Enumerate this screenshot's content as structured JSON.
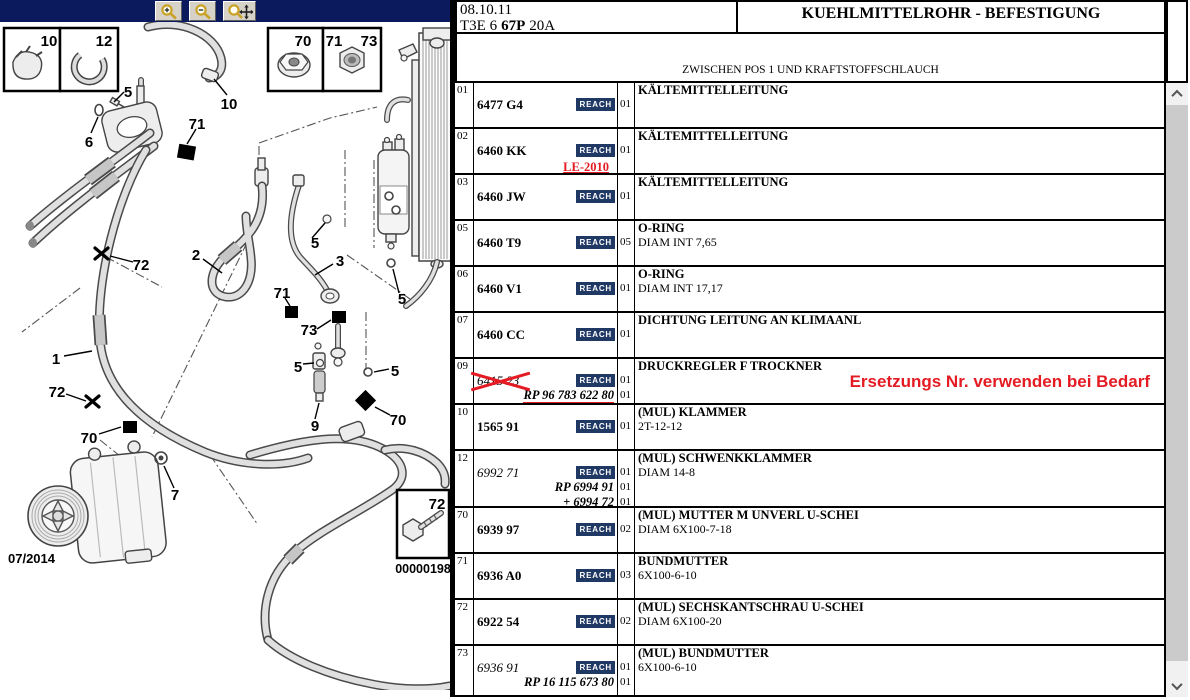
{
  "toolbar": {
    "bar_color": "#0a1a5c",
    "buttons": [
      {
        "icon": "zoom-in-icon"
      },
      {
        "icon": "zoom-out-icon"
      },
      {
        "icon": "zoom-pan-icon"
      }
    ]
  },
  "header": {
    "date": "08.10.11",
    "code": {
      "part1": "T3E 6",
      "part2": "67P",
      "part3": "20A"
    },
    "title": "KUEHLMITTELROHR - BEFESTIGUNG",
    "subtitle": "ZWISCHEN POS 1 UND KRAFTSTOFFSCHLAUCH"
  },
  "diagram": {
    "date_label": "07/2014",
    "image_number": "00000198",
    "callouts": [
      {
        "label": "10",
        "x": 49,
        "y": 41
      },
      {
        "label": "12",
        "x": 104,
        "y": 41
      },
      {
        "label": "70",
        "x": 303,
        "y": 41
      },
      {
        "label": "71",
        "x": 334,
        "y": 41
      },
      {
        "label": "73",
        "x": 369,
        "y": 41
      },
      {
        "label": "72",
        "x": 437,
        "y": 504
      },
      {
        "label": "5",
        "x": 128,
        "y": 92
      },
      {
        "label": "6",
        "x": 89,
        "y": 142
      },
      {
        "label": "10",
        "x": 229,
        "y": 104
      },
      {
        "label": "71",
        "x": 197,
        "y": 124
      },
      {
        "label": "2",
        "x": 196,
        "y": 255
      },
      {
        "label": "72",
        "x": 141,
        "y": 265
      },
      {
        "label": "3",
        "x": 340,
        "y": 261
      },
      {
        "label": "5",
        "x": 315,
        "y": 243
      },
      {
        "label": "5",
        "x": 402,
        "y": 299
      },
      {
        "label": "71",
        "x": 282,
        "y": 293
      },
      {
        "label": "73",
        "x": 309,
        "y": 330
      },
      {
        "label": "5",
        "x": 298,
        "y": 367
      },
      {
        "label": "5",
        "x": 395,
        "y": 371
      },
      {
        "label": "9",
        "x": 315,
        "y": 426
      },
      {
        "label": "70",
        "x": 398,
        "y": 420
      },
      {
        "label": "1",
        "x": 56,
        "y": 359
      },
      {
        "label": "72",
        "x": 57,
        "y": 392
      },
      {
        "label": "70",
        "x": 89,
        "y": 438
      },
      {
        "label": "7",
        "x": 175,
        "y": 495
      }
    ]
  },
  "table": {
    "reach_label": "REACH",
    "rows": [
      {
        "pos": "01",
        "part": "6477 G4",
        "style": "bold",
        "qty": [
          "01"
        ],
        "desc": [
          "KÄLTEMITTELLEITUNG"
        ]
      },
      {
        "pos": "02",
        "part": "6460 KK",
        "style": "bold",
        "qty": [
          "01"
        ],
        "desc": [
          "KÄLTEMITTELLEITUNG"
        ],
        "note": "LE-2010"
      },
      {
        "pos": "03",
        "part": "6460 JW",
        "style": "bold",
        "qty": [
          "01"
        ],
        "desc": [
          "KÄLTEMITTELLEITUNG"
        ]
      },
      {
        "pos": "05",
        "part": "6460 T9",
        "style": "bold",
        "qty": [
          "05"
        ],
        "desc": [
          "O-RING",
          "DIAM INT 7,65"
        ]
      },
      {
        "pos": "06",
        "part": "6460 V1",
        "style": "bold",
        "qty": [
          "01"
        ],
        "desc": [
          "O-RING",
          "DIAM INT 17,17"
        ]
      },
      {
        "pos": "07",
        "part": "6460 CC",
        "style": "bold",
        "qty": [
          "01"
        ],
        "desc": [
          "DICHTUNG LEITUNG AN KLIMAANL"
        ]
      },
      {
        "pos": "09",
        "part": "6415 23",
        "style": "italic",
        "crossed": true,
        "rp_lines": [
          {
            "text": "RP 96 783 622 80",
            "underline": true
          }
        ],
        "qty": [
          "01",
          "01"
        ],
        "desc": [
          "DRUCKREGLER F TROCKNER"
        ],
        "annotation": "Ersetzungs Nr. verwenden bei Bedarf"
      },
      {
        "pos": "10",
        "part": "1565 91",
        "style": "bold",
        "qty": [
          "01"
        ],
        "desc": [
          "(MUL) KLAMMER",
          "2T-12-12"
        ]
      },
      {
        "pos": "12",
        "part": "6992 71",
        "style": "italic",
        "h": 57,
        "rp_lines": [
          {
            "text": "RP 6994 91"
          },
          {
            "text": "+ 6994 72"
          }
        ],
        "qty": [
          "01",
          "01",
          "01"
        ],
        "desc": [
          "(MUL) SCHWENKKLAMMER",
          "DIAM 14-8"
        ]
      },
      {
        "pos": "70",
        "part": "6939 97",
        "style": "bold",
        "qty": [
          "02"
        ],
        "desc": [
          "(MUL) MUTTER M UNVERL U-SCHEI",
          "DIAM 6X100-7-18"
        ]
      },
      {
        "pos": "71",
        "part": "6936 A0",
        "style": "bold",
        "qty": [
          "03"
        ],
        "desc": [
          "BUNDMUTTER",
          "6X100-6-10"
        ]
      },
      {
        "pos": "72",
        "part": "6922 54",
        "style": "bold",
        "qty": [
          "02"
        ],
        "desc": [
          "(MUL) SECHSKANTSCHRAU U-SCHEI",
          "DIAM 6X100-20"
        ]
      },
      {
        "pos": "73",
        "part": "6936 91",
        "style": "italic",
        "h": 49,
        "rp_lines": [
          {
            "text": "RP 16 115 673 80"
          }
        ],
        "qty": [
          "01",
          "01"
        ],
        "desc": [
          "(MUL) BUNDMUTTER",
          "6X100-6-10"
        ]
      }
    ]
  },
  "colors": {
    "reach_bg": "#1f3864",
    "red": "#e41b23",
    "navy_bar": "#0a1a5c"
  }
}
